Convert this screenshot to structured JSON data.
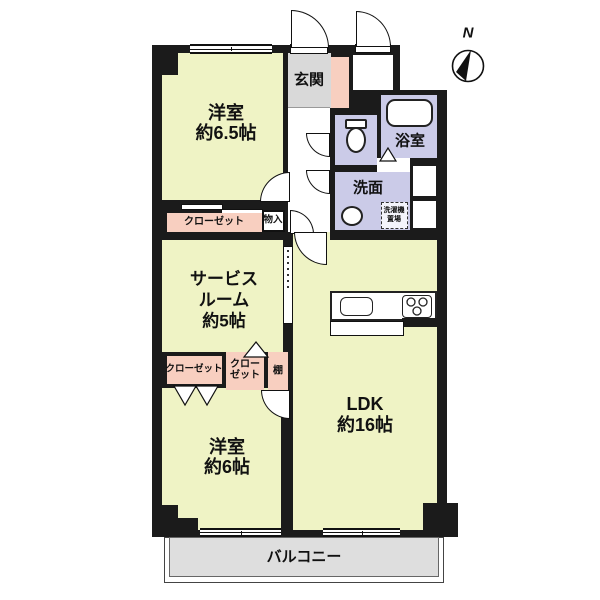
{
  "compass": {
    "north_label": "N"
  },
  "rooms": {
    "western_room_1": {
      "name": "洋室",
      "area": "約6.5帖"
    },
    "entrance": {
      "label": "玄関"
    },
    "bathroom": {
      "label": "浴室"
    },
    "washroom": {
      "label": "洗面"
    },
    "laundry": {
      "line1": "洗濯機",
      "line2": "置場"
    },
    "service_room": {
      "line1": "サービス",
      "line2": "ルーム",
      "line3": "約5帖"
    },
    "closet_top": {
      "label": "クローゼット"
    },
    "storage": {
      "label": "物入"
    },
    "closet_mid_left": {
      "label": "クローゼット"
    },
    "closet_mid_center": {
      "line1": "クロー",
      "line2": "ゼット"
    },
    "shelf": {
      "label": "棚"
    },
    "western_room_2": {
      "name": "洋室",
      "area": "約6帖"
    },
    "ldk": {
      "name": "LDK",
      "area": "約16帖"
    },
    "balcony": {
      "label": "バルコニー"
    }
  },
  "icons": [
    "compass-north-icon",
    "toilet-icon",
    "bathtub-icon",
    "sink-icon",
    "kitchen-sink-icon",
    "stove-icon"
  ],
  "colors": {
    "room_yellow": "#eff3c5",
    "wet_area_lavender": "#cbcbe8",
    "closet_pink": "#f8cfc0",
    "entrance_gray": "#d9d9d9",
    "balcony_gray": "#dedede",
    "wall_black": "#1b1b1b"
  }
}
